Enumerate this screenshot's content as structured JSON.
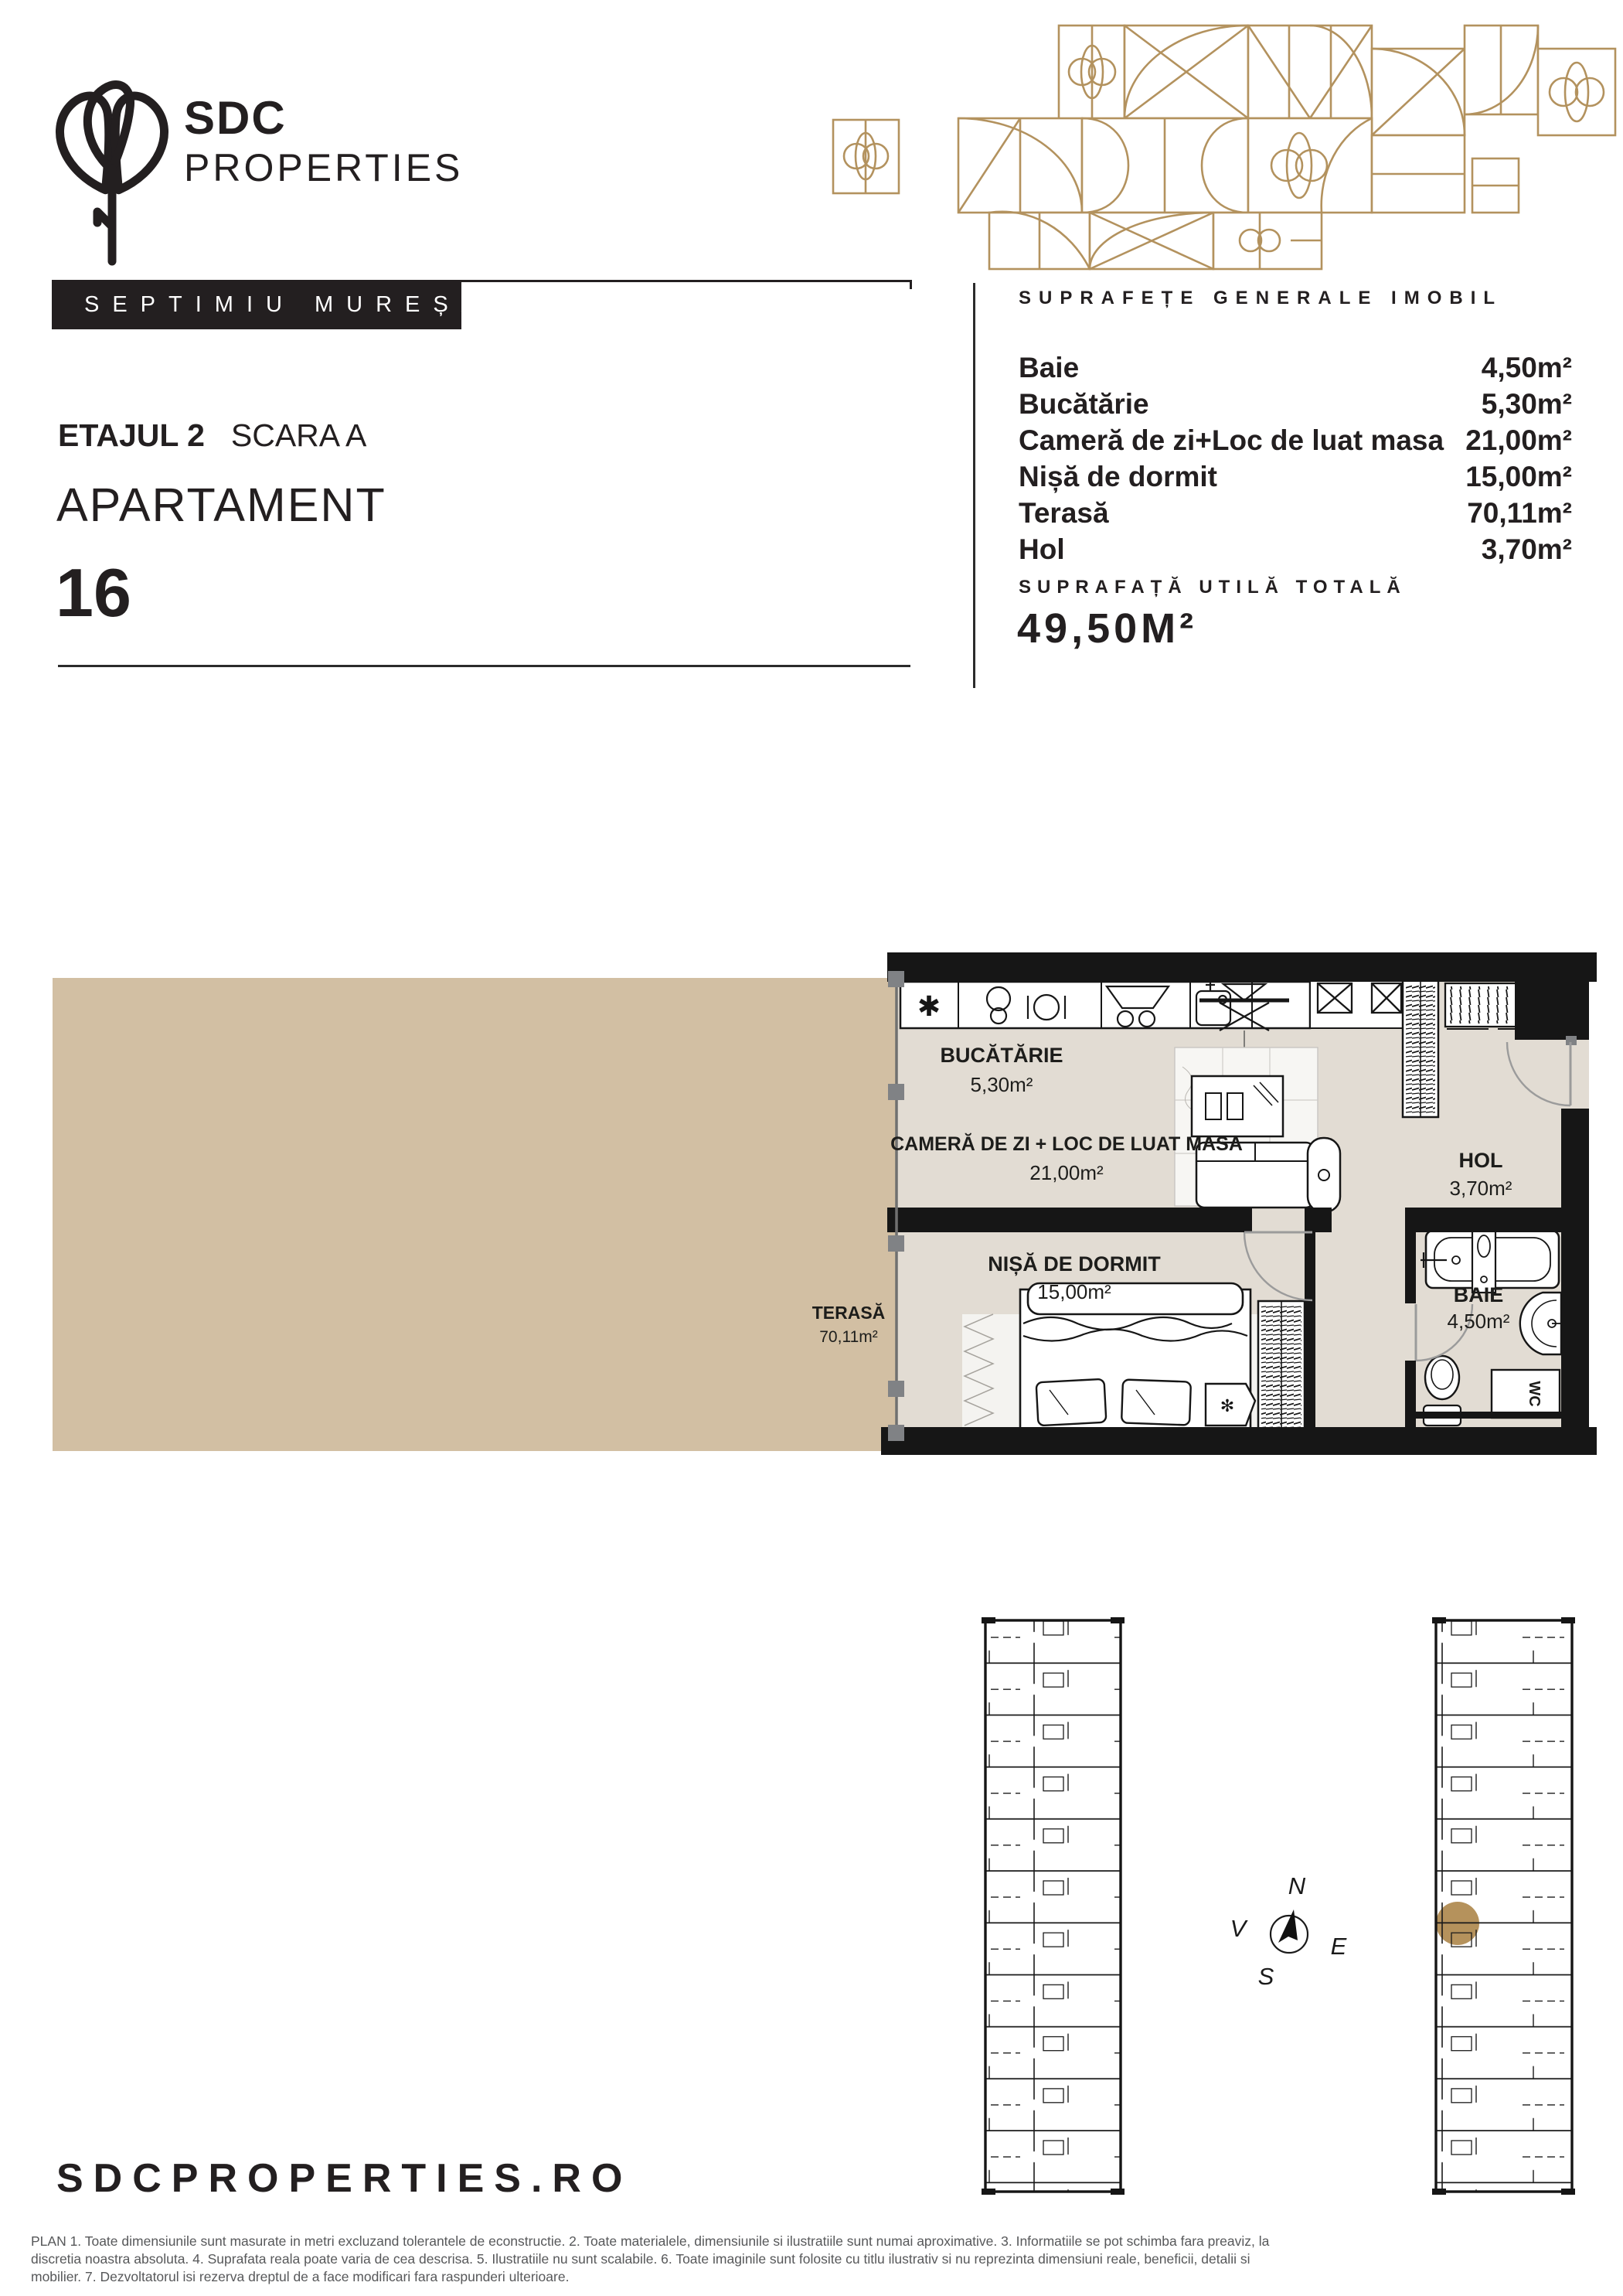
{
  "brand": {
    "name_top": "SDC",
    "name_bottom": "PROPERTIES"
  },
  "agent_badge": "SEPTIMIU MUREȘAN",
  "header": {
    "floor_label": "ETAJUL 2",
    "staircase_label": "SCARA A",
    "unit_type": "APARTAMENT",
    "unit_number": "16"
  },
  "areas_panel": {
    "title": "SUPRAFEȚE GENERALE IMOBIL",
    "items": [
      {
        "label": "Baie",
        "value": "4,50m²"
      },
      {
        "label": "Bucătărie",
        "value": "5,30m²"
      },
      {
        "label": "Cameră de zi+Loc de luat masa",
        "value": "21,00m²"
      },
      {
        "label": "Nișă de dormit",
        "value": "15,00m²"
      },
      {
        "label": "Terasă",
        "value": "70,11m²"
      },
      {
        "label": "Hol",
        "value": "3,70m²"
      }
    ],
    "total_label": "SUPRAFAȚĂ UTILĂ TOTALĂ",
    "total_value": "49,50M²"
  },
  "floor_plan": {
    "kitchen": {
      "name": "BUCĂTĂRIE",
      "area": "5,30m²"
    },
    "living": {
      "name": "CAMERĂ DE ZI + LOC DE LUAT MASA",
      "area": "21,00m²"
    },
    "bedroom": {
      "name": "NIȘĂ DE DORMIT",
      "area": "15,00m²"
    },
    "hall": {
      "name": "HOL",
      "area": "3,70m²"
    },
    "bath": {
      "name": "BAIE",
      "area": "4,50m²"
    },
    "terrace": {
      "name": "TERASĂ",
      "area": "70,11m²"
    },
    "wc_label": "WC"
  },
  "compass": {
    "n": "N",
    "e": "E",
    "s": "S",
    "v": "V"
  },
  "footer": {
    "website": "SDCPROPERTIES.RO",
    "disclaimer_lines": [
      "PLAN 1. Toate dimensiunile sunt masurate in metri excluzand tolerantele de econstructie. 2. Toate materialele, dimensiunile si ilustratiile sunt numai aproximative. 3. Informatiile se pot schimba fara preaviz, la",
      "discretia noastra absoluta. 4. Suprafata reala poate varia de cea descrisa. 5. Ilustratiile nu sunt scalabile. 6. Toate imaginile sunt folosite cu titlu ilustrativ si nu reprezinta dimensiuni reale, beneficii, detalii si",
      "mobilier. 7. Dezvoltatorul isi rezerva dreptul de a face modificari fara raspunderi ulterioare."
    ]
  },
  "colors": {
    "accent_gold": "#b3925e",
    "terrace_fill": "#d2bfa3",
    "floor_fill": "#e2dcd3",
    "wall_black": "#161616",
    "marker_gray": "#808285",
    "text_black": "#231f20",
    "disclaimer_gray": "#57585a"
  }
}
